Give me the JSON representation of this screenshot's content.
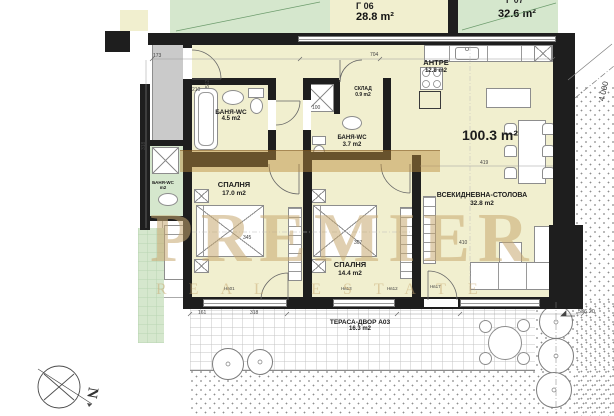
{
  "palette": {
    "room_fill": "#f1efcf",
    "green_fill": "#d5e7cd",
    "wall": "#1e1e1e",
    "corridor_fill": "#cacaca",
    "watermark_tan": "#c7a770",
    "paper": "#ffffff"
  },
  "units": {
    "g06": {
      "code": "Г 06",
      "area": "28.8 m²"
    },
    "g07": {
      "code": "Г 07",
      "area": "32.6 m²"
    }
  },
  "apartment": {
    "total_area": "100.3 m²",
    "rooms": {
      "antre": {
        "name": "АНТРЕ",
        "area": "12.8 m2"
      },
      "sklad": {
        "name": "СКЛАД",
        "area": "0.9 m2"
      },
      "bath_main": {
        "name": "БАНЯ-WC",
        "area": "4.5 m2"
      },
      "bath_second": {
        "name": "БАНЯ-WC",
        "area": "3.7 m2"
      },
      "bedroom_1": {
        "name": "СПАЛНЯ",
        "area": "17.0 m2"
      },
      "bedroom_2": {
        "name": "СПАЛНЯ",
        "area": "14.4 m2"
      },
      "living": {
        "name": "ВСЕКИДНЕВНА-СТОЛОВА",
        "area": "32.8 m2"
      },
      "terrace": {
        "name": "ТЕРАСА-ДВОР А03",
        "area": "16.3 m2"
      },
      "neighbor_bath": {
        "name": "БАНЯ-WC",
        "area": "m2"
      }
    }
  },
  "dims": [
    "173",
    "210",
    "562",
    "704",
    "318",
    "100",
    "419",
    "345",
    "307",
    "410",
    "Нв01",
    "Нв13",
    "Нв12",
    "Нв17",
    "161",
    "318"
  ],
  "annotations": {
    "elevation": "536.20",
    "boundary_dim": "4 000"
  },
  "compass": {
    "north": "N"
  },
  "watermark": {
    "line1": "PREMIER",
    "line2": "REAL ESTATE"
  }
}
